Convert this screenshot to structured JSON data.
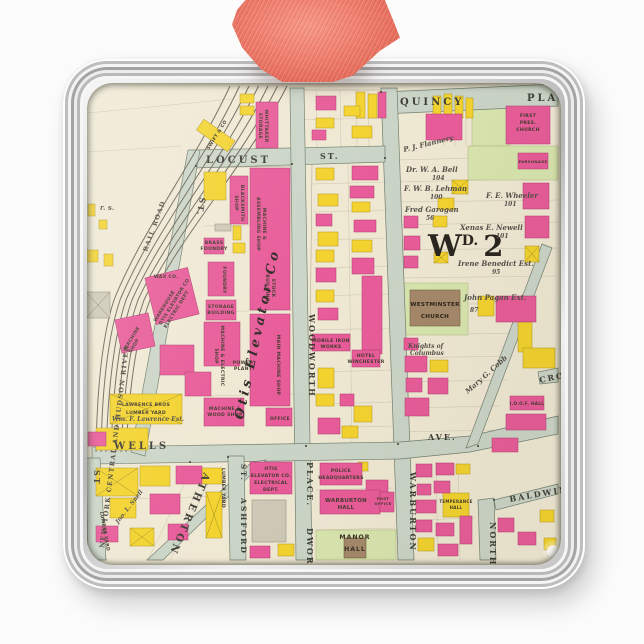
{
  "palette": {
    "background": "#fcfcfc",
    "frame_silver": "#d6d6d6",
    "ribbon": "#ee7767",
    "paper": "#efe8d3",
    "building_pink": "#e85c99",
    "building_yellow": "#f3d32f",
    "road": "#cbd5c7",
    "lot_green": "#d8e5ae",
    "church_brown": "#a5886a"
  },
  "map": {
    "ward": {
      "w": "W",
      "sup": "D.",
      "num": "2"
    },
    "streets": {
      "quincy": "QUINCY",
      "place": "PLACE",
      "locust": "LOCUST",
      "locust_st": "ST.",
      "woodworth": "WOODWORTH",
      "place_lower": "PLACE.",
      "dworth": "DWORTH",
      "wells": "WELLS",
      "ave": "AVE.",
      "atherton": "ATHERTON",
      "ashford": "ASHFORD",
      "ashford_st": "ST.",
      "warburton": "WARBURTON",
      "north": "NORTH",
      "baldwin": "BALDWIN",
      "cro": "CRO",
      "west_st": "ST.",
      "left_st": "ST"
    },
    "railroad": {
      "line1": "RAIL ROAD",
      "line2": "NEW YORK CENTRAL AND HUDSON RIVER"
    },
    "buildings": {
      "blacksmith1": "BLACKSMITH",
      "blacksmith2": "SHOP",
      "assembling1": "MACHINE &",
      "assembling2": "ASSEMBLING SHOP",
      "brass1": "BRASS",
      "brass2": "FOUNDRY",
      "foundry": "FOUNDRY",
      "storage1": "STORAGE",
      "storage2": "BUILDING",
      "stock1": "STOCK",
      "stock2": "BUILDING",
      "machelec1": "MACHINE & ELECTRIC",
      "machelec2": "SHOP",
      "power1": "POWER",
      "power2": "PLANT",
      "mainmach": "MAIN MACHINE SHOP",
      "wood1": "MACHINE &",
      "wood2": "WOOD SHOP",
      "office": "OFFICE",
      "otis_script": "Otis Elevator Co",
      "warehouse1": "WAREHOUSE",
      "warehouse2": "OTIS ELEVATOR CO",
      "warehouse3": "ELECTRIC DEPT",
      "machshop1": "MACHINE",
      "machshop2": "SHOP",
      "wax": "WAX CO.",
      "lawrence1": "LAWRENCE BROS",
      "lawrence2": "LUMBER YARD",
      "lumber": "LUMBER YARD",
      "otiselec1": "OTIS",
      "otiselec2": "ELEVATOR CO.",
      "otiselec3": "ELECTRICAL",
      "otiselec4": "DEPT.",
      "mobile1": "MOBILE IRON",
      "mobile2": "WORKS",
      "hotel1": "HOTEL",
      "hotel2": "WINCHESTER",
      "whittaker1": "WHITTAKER",
      "whittaker2": "STORAGE",
      "swift": "SWIFT & CO",
      "police1": "POLICE",
      "police2": "HEADQUARTERS",
      "warbhall1": "WARBURTON",
      "warbhall2": "HALL",
      "post1": "POST",
      "post2": "OFFICE",
      "manor1": "MANOR",
      "manor2": "HALL",
      "temperance1": "TEMPERANCE",
      "temperance2": "HALL",
      "ioof": "I.O.O.F. HALL",
      "firstpres1": "FIRST",
      "firstpres2": "PRES.",
      "firstpres3": "CHURCH",
      "parsonage": "PARSONAGE",
      "westminster1": "WESTMINSTER",
      "westminster2": "CHURCH"
    },
    "owners": {
      "flannery": "P. J. Flannery",
      "bell": "Dr. W. A. Bell",
      "bell_no": "104",
      "lehman": "F. W. B. Lehman",
      "lehman_no": "100",
      "garagan": "Fred Garagan",
      "garagan_no": "56",
      "wheeler": "F. E. Wheeler",
      "wheeler_no": "101",
      "newell": "Xenas E. Newell",
      "newell_no": "101",
      "benedict": "Irene Benedict Est.",
      "benedict_no": "95",
      "pagan": "John Pagan Ext.",
      "pagan_no": "87",
      "knights1": "Knights of",
      "knights2": "Columbus",
      "cobb": "Mary G. Cobb",
      "lawrence": "Wm. F. Lawrence Est.",
      "snell": "Jno. L. Snell",
      "frag": "r. s."
    }
  }
}
